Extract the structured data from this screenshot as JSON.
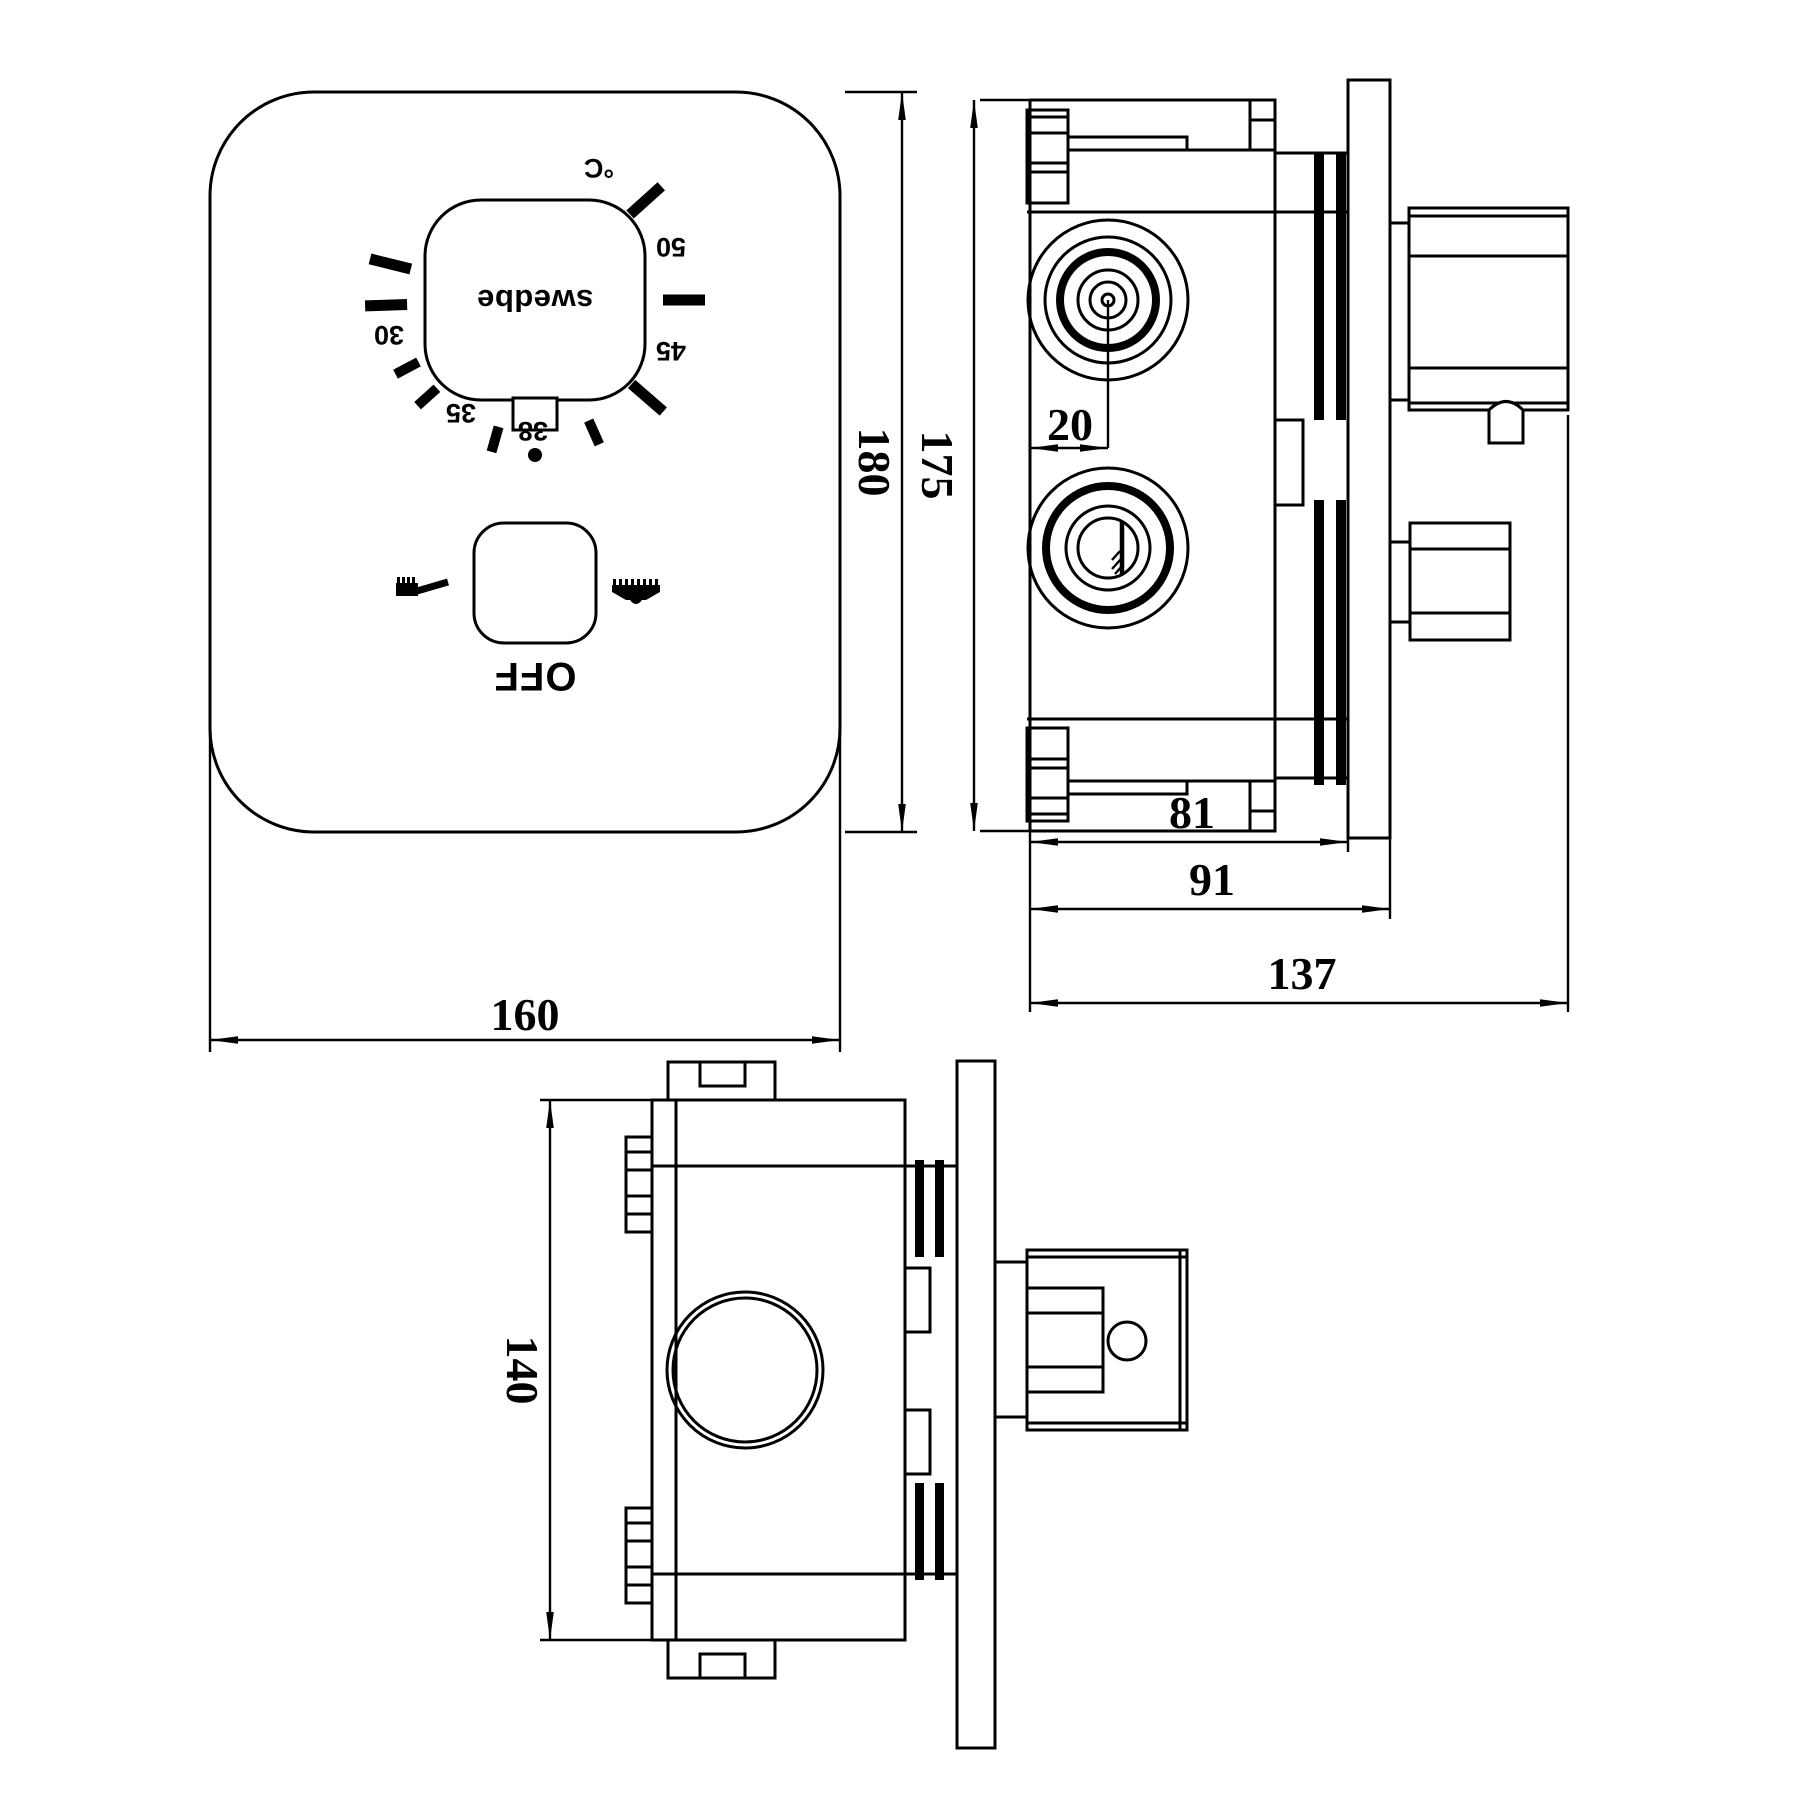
{
  "colors": {
    "line": "#000000",
    "background": "#ffffff"
  },
  "front_view": {
    "dial": {
      "brand": "swedbe",
      "unit_label": "°C",
      "scale_labels": {
        "t50": "50",
        "t45": "45",
        "t38": "38",
        "t35": "35",
        "t30": "30"
      }
    },
    "diverter": {
      "off_label": "OFF"
    },
    "dims": {
      "width": "160",
      "height": "180"
    }
  },
  "side_view": {
    "dims": {
      "body_height": "175",
      "port_offset": "20",
      "body_depth": "81",
      "depth_to_plate": "91",
      "overall_depth": "137"
    }
  },
  "bottom_view": {
    "dims": {
      "body_width": "140"
    }
  }
}
